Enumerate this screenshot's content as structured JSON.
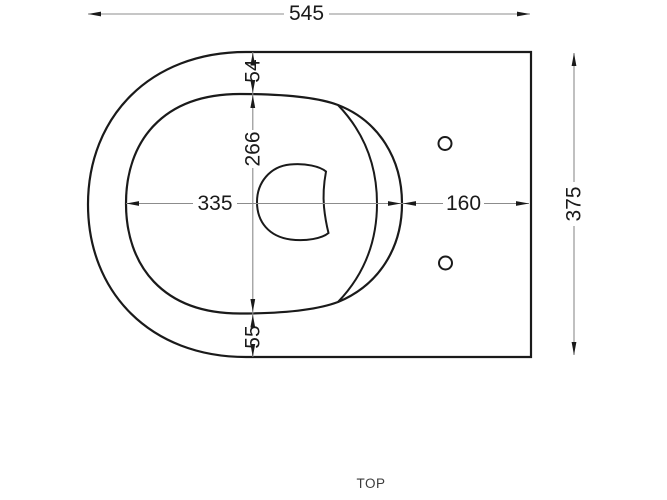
{
  "drawing": {
    "view_label": "TOP",
    "dimensions": {
      "overall_width": "545",
      "overall_depth": "375",
      "bowl_offset_top": "54",
      "bowl_opening_depth": "266",
      "bowl_opening_length": "335",
      "rear_section_length": "160",
      "bowl_offset_bottom": "55"
    },
    "colors": {
      "outline": "#1a1a1a",
      "dimension_line": "#8c8c8c",
      "dimension_text": "#1a1a1a",
      "view_label_text": "#3c3c3c",
      "background": "#ffffff"
    }
  }
}
